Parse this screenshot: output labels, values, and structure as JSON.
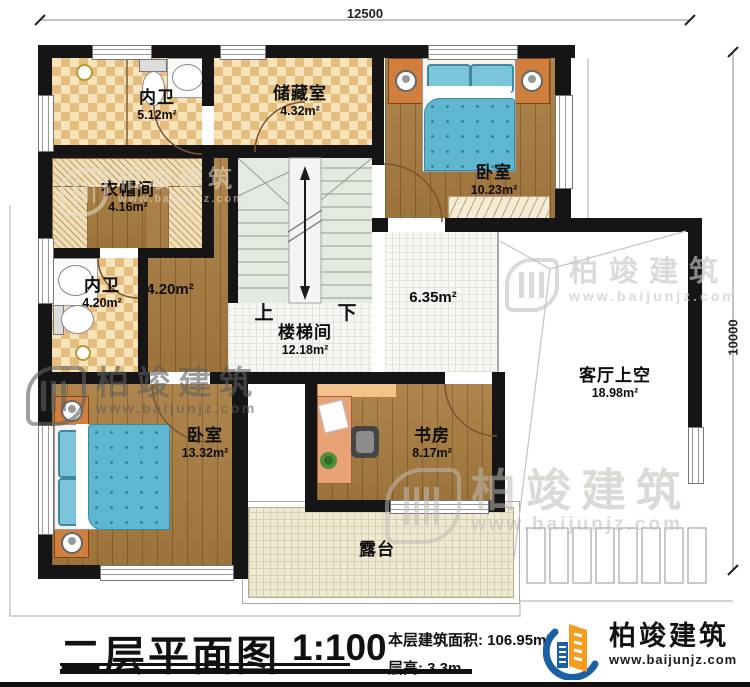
{
  "dimensions": {
    "top": "12500",
    "right": "10000"
  },
  "rooms": [
    {
      "name": "内卫",
      "area": "5.12m²"
    },
    {
      "name": "储藏室",
      "area": "4.32m²"
    },
    {
      "name": "卧室",
      "area": "10.23m²"
    },
    {
      "name": "衣帽间",
      "area": "4.16m²"
    },
    {
      "name": "内卫",
      "area": "4.20m²"
    },
    {
      "name": "",
      "area": "4.20m²"
    },
    {
      "name": "楼梯间",
      "area": "12.18m²"
    },
    {
      "name": "",
      "area": "6.35m²"
    },
    {
      "name": "客厅上空",
      "area": "18.98m²"
    },
    {
      "name": "卧室",
      "area": "13.32m²"
    },
    {
      "name": "书房",
      "area": "8.17m²"
    },
    {
      "name": "露台",
      "area": ""
    }
  ],
  "stairs": {
    "up": "上",
    "down": "下"
  },
  "title_block": {
    "title": "二层平面图",
    "scale": "1:100",
    "area_label": "本层建筑面积:",
    "area_value": "106.95m²",
    "floor_height_label": "层高:",
    "floor_height_value": "3.3m"
  },
  "brand": {
    "name": "柏竣建筑",
    "url": "www.baijunjz.com"
  },
  "watermark": {
    "name": "柏竣建筑",
    "url": "www.baijunjz.com"
  },
  "colors": {
    "wall": "#151515",
    "wood": "#a87c3f",
    "tile_beige": "#f6e3b9",
    "bed_blue": "#5fb7cf",
    "brand_blue": "#1b5fa5",
    "brand_orange": "#f59c1c"
  }
}
